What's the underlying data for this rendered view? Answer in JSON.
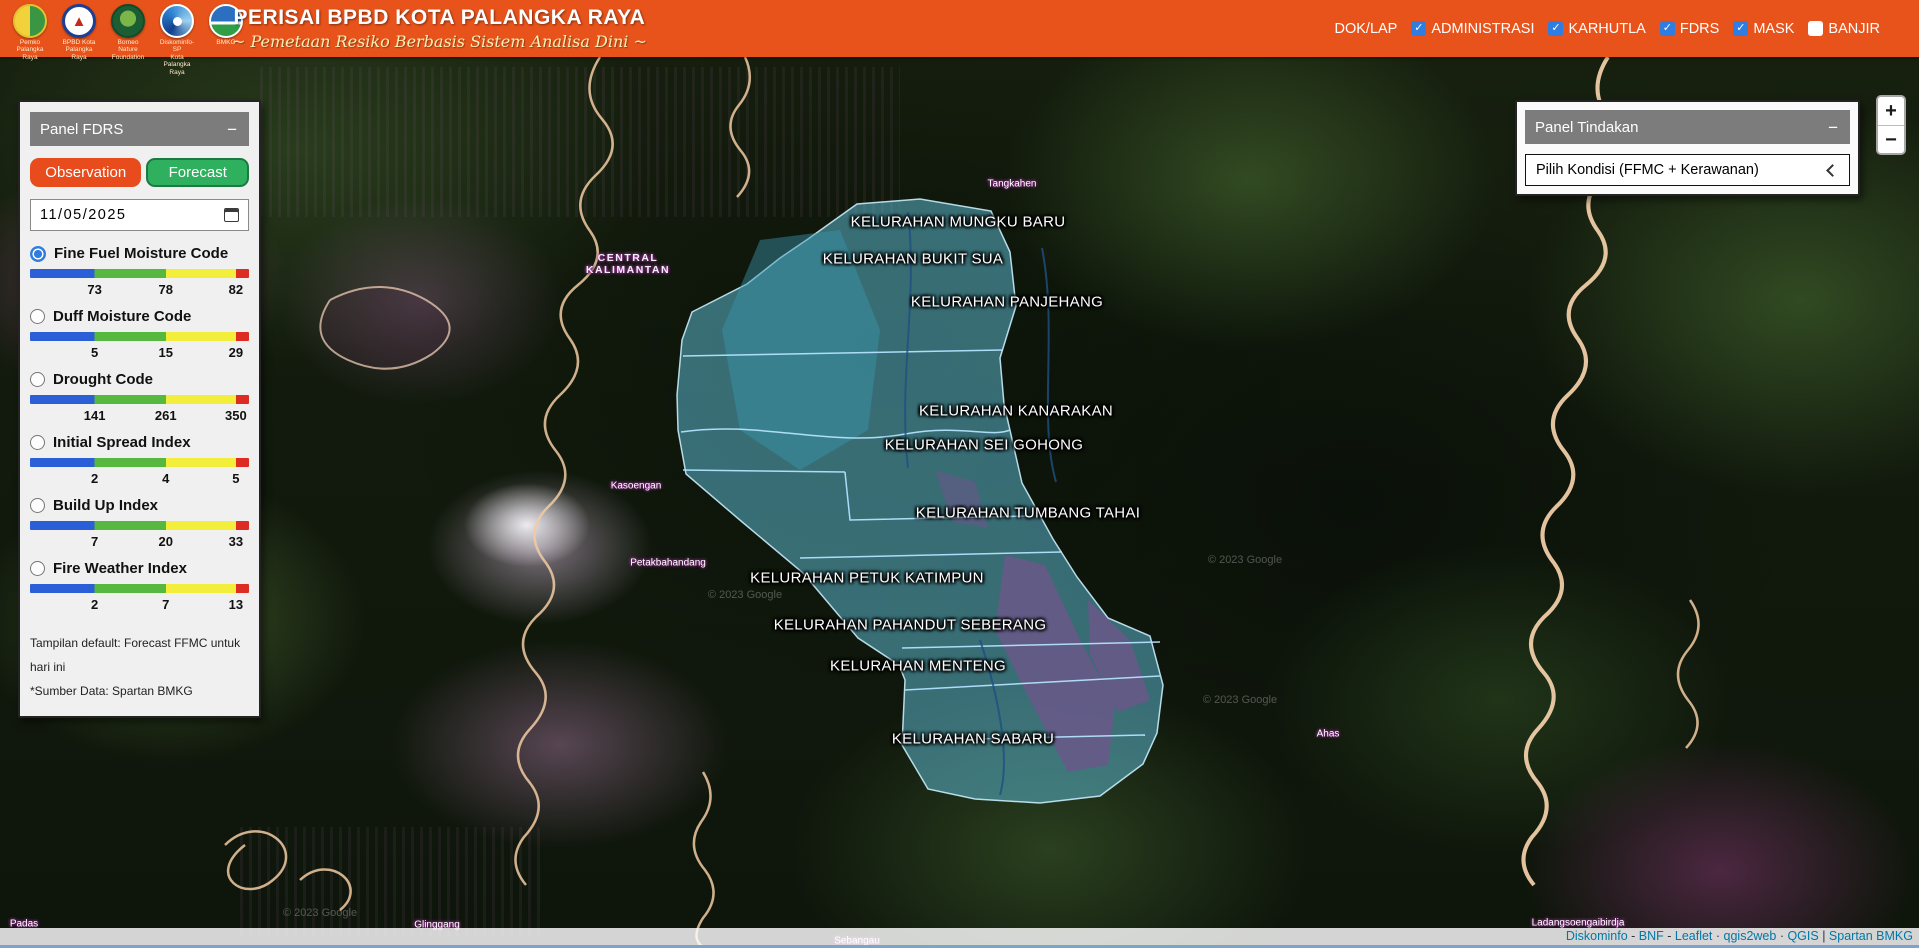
{
  "header": {
    "title": "PERISAI BPBD KOTA PALANGKA RAYA",
    "subtitle": "~ Pemetaan Resiko Berbasis Sistem Analisa Dini ~",
    "logos": [
      {
        "name": "pemko-palangka-raya",
        "caption": "Pemko\nPalangka Raya"
      },
      {
        "name": "bpbd-kota-palangka-raya",
        "caption": "BPBD Kota\nPalangka Raya"
      },
      {
        "name": "borneo-nature-foundation",
        "caption": "Borneo\nNature Foundation"
      },
      {
        "name": "diskominfo-sp",
        "caption": "Diskominfo-SP\nKota Palangka Raya"
      },
      {
        "name": "bmkg",
        "caption": "BMKG"
      }
    ],
    "nav": {
      "doklap_label": "DOK/LAP",
      "layers": [
        {
          "label": "ADMINISTRASI",
          "checked": true
        },
        {
          "label": "KARHUTLA",
          "checked": true
        },
        {
          "label": "FDRS",
          "checked": true
        },
        {
          "label": "MASK",
          "checked": true
        },
        {
          "label": "BANJIR",
          "checked": false
        }
      ]
    }
  },
  "panel_fdrs": {
    "title": "Panel FDRS",
    "collapse_label": "−",
    "buttons": {
      "observation": "Observation",
      "forecast": "Forecast"
    },
    "date_value": "11/05/2025",
    "indices": [
      {
        "label": "Fine Fuel Moisture Code",
        "selected": true,
        "thresholds": [
          "73",
          "78",
          "82"
        ]
      },
      {
        "label": "Duff Moisture Code",
        "selected": false,
        "thresholds": [
          "5",
          "15",
          "29"
        ]
      },
      {
        "label": "Drought Code",
        "selected": false,
        "thresholds": [
          "141",
          "261",
          "350"
        ]
      },
      {
        "label": "Initial Spread Index",
        "selected": false,
        "thresholds": [
          "2",
          "4",
          "5"
        ]
      },
      {
        "label": "Build Up Index",
        "selected": false,
        "thresholds": [
          "7",
          "20",
          "33"
        ]
      },
      {
        "label": "Fire Weather Index",
        "selected": false,
        "thresholds": [
          "2",
          "7",
          "13"
        ]
      }
    ],
    "scale_colors": [
      "#2a5fd7",
      "#56b83e",
      "#f3ee3c",
      "#dd2d22"
    ],
    "footnotes": [
      "Tampilan default: Forecast FFMC untuk hari ini",
      "*Sumber Data: Spartan BMKG"
    ]
  },
  "panel_tindakan": {
    "title": "Panel Tindakan",
    "collapse_label": "−",
    "select_value": "Pilih Kondisi (FFMC + Kerawanan)"
  },
  "map": {
    "zoom_in": "+",
    "zoom_out": "−",
    "accent_colors": {
      "region_fill": "#60bdd6",
      "region_line": "#c8ebfa",
      "purple_zone": "#69588a"
    },
    "region_labels": [
      {
        "text": "KELURAHAN MUNGKU BARU",
        "x": 958,
        "y": 222
      },
      {
        "text": "KELURAHAN BUKIT SUA",
        "x": 913,
        "y": 259
      },
      {
        "text": "KELURAHAN PANJEHANG",
        "x": 1007,
        "y": 302
      },
      {
        "text": "KELURAHAN KANARAKAN",
        "x": 1016,
        "y": 411
      },
      {
        "text": "KELURAHAN SEI GOHONG",
        "x": 984,
        "y": 445
      },
      {
        "text": "KELURAHAN TUMBANG TAHAI",
        "x": 1028,
        "y": 513
      },
      {
        "text": "KELURAHAN PETUK KATIMPUN",
        "x": 867,
        "y": 578
      },
      {
        "text": "KELURAHAN PAHANDUT SEBERANG",
        "x": 910,
        "y": 625
      },
      {
        "text": "KELURAHAN MENTENG",
        "x": 918,
        "y": 666
      },
      {
        "text": "KELURAHAN SABARU",
        "x": 973,
        "y": 739
      }
    ],
    "place_labels": [
      {
        "text": "CENTRAL\nKALIMANTAN",
        "x": 628,
        "y": 264,
        "kind": "caps"
      },
      {
        "text": "Tangkahen",
        "x": 1012,
        "y": 184,
        "kind": "place"
      },
      {
        "text": "Kasoengan",
        "x": 636,
        "y": 486,
        "kind": "place"
      },
      {
        "text": "Petakbahandang",
        "x": 668,
        "y": 563,
        "kind": "place"
      },
      {
        "text": "Ahas",
        "x": 1328,
        "y": 734,
        "kind": "place"
      },
      {
        "text": "Glinggang",
        "x": 437,
        "y": 925,
        "kind": "place"
      },
      {
        "text": "Padas",
        "x": 24,
        "y": 924,
        "kind": "place"
      },
      {
        "text": "Sebangau",
        "x": 857,
        "y": 941,
        "kind": "place"
      },
      {
        "text": "Ladangsoengaibirdja",
        "x": 1578,
        "y": 923,
        "kind": "place"
      }
    ],
    "watermark_text": "© 2023 Google",
    "watermarks": [
      {
        "x": 745,
        "y": 595
      },
      {
        "x": 1245,
        "y": 560
      },
      {
        "x": 1240,
        "y": 700
      },
      {
        "x": 320,
        "y": 913
      }
    ],
    "attribution": {
      "parts": [
        {
          "text": "Diskominfo",
          "link": true
        },
        {
          "text": " - ",
          "link": false
        },
        {
          "text": "BNF",
          "link": true
        },
        {
          "text": " - ",
          "link": false
        },
        {
          "text": "Leaflet",
          "link": true
        },
        {
          "text": " · ",
          "link": false
        },
        {
          "text": "qgis2web",
          "link": true
        },
        {
          "text": " · ",
          "link": false
        },
        {
          "text": "QGIS",
          "link": true
        },
        {
          "text": " | ",
          "link": false
        },
        {
          "text": "Spartan BMKG",
          "link": true
        }
      ]
    }
  }
}
